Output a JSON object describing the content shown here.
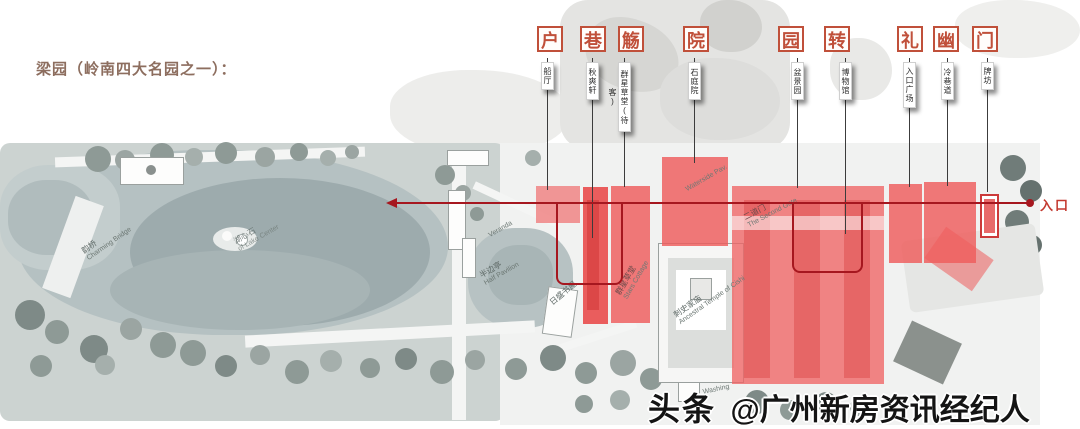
{
  "page": {
    "title": "梁园（岭南四大名园之一）："
  },
  "tour": {
    "stops": [
      {
        "concept": "户",
        "spot": "船厅"
      },
      {
        "concept": "巷",
        "spot": "秋爽轩"
      },
      {
        "concept": "觞",
        "spot": "群星草堂(待客)"
      },
      {
        "concept": "院",
        "spot": "石庭院"
      },
      {
        "concept": "园",
        "spot": "盆景园"
      },
      {
        "concept": "转",
        "spot": "博物馆"
      },
      {
        "concept": "礼",
        "spot": "入口广场"
      },
      {
        "concept": "幽",
        "spot": "冷巷道"
      },
      {
        "concept": "门",
        "spot": "牌坊"
      }
    ]
  },
  "map": {
    "entrance_label": "入口",
    "labels": {
      "charming_bridge_cn": "韵桥",
      "charming_bridge_en": "Charming Bridge",
      "lake_center_cn": "湖心石",
      "lake_center_en": "of Lake Center",
      "veranda_en": "Veranda",
      "half_pavilion_cn": "半边亭",
      "half_pavilion_en": "Half Pavilion",
      "study_cn": "日盛书屋",
      "stars_cottage_cn": "群星草堂",
      "stars_cottage_en": "Stars Cottage",
      "second_gate_cn": "二道门",
      "second_gate_en": "The Second Gate",
      "ancestral_cn": "刺史家庙",
      "ancestral_en": "Ancestral Temple of Cishi",
      "waterside_en": "Waterside Pav.",
      "washing_en": "Washing"
    }
  },
  "watermark": {
    "brand": "头条",
    "handle": "@广州新房资讯经纪人"
  },
  "colors": {
    "title_brown": "#8d6e5f",
    "accent_red": "#c0503a",
    "route_red": "#a6171f",
    "highlight_red": "#ee5c5c",
    "lake_gray": "#b5c1c2"
  }
}
